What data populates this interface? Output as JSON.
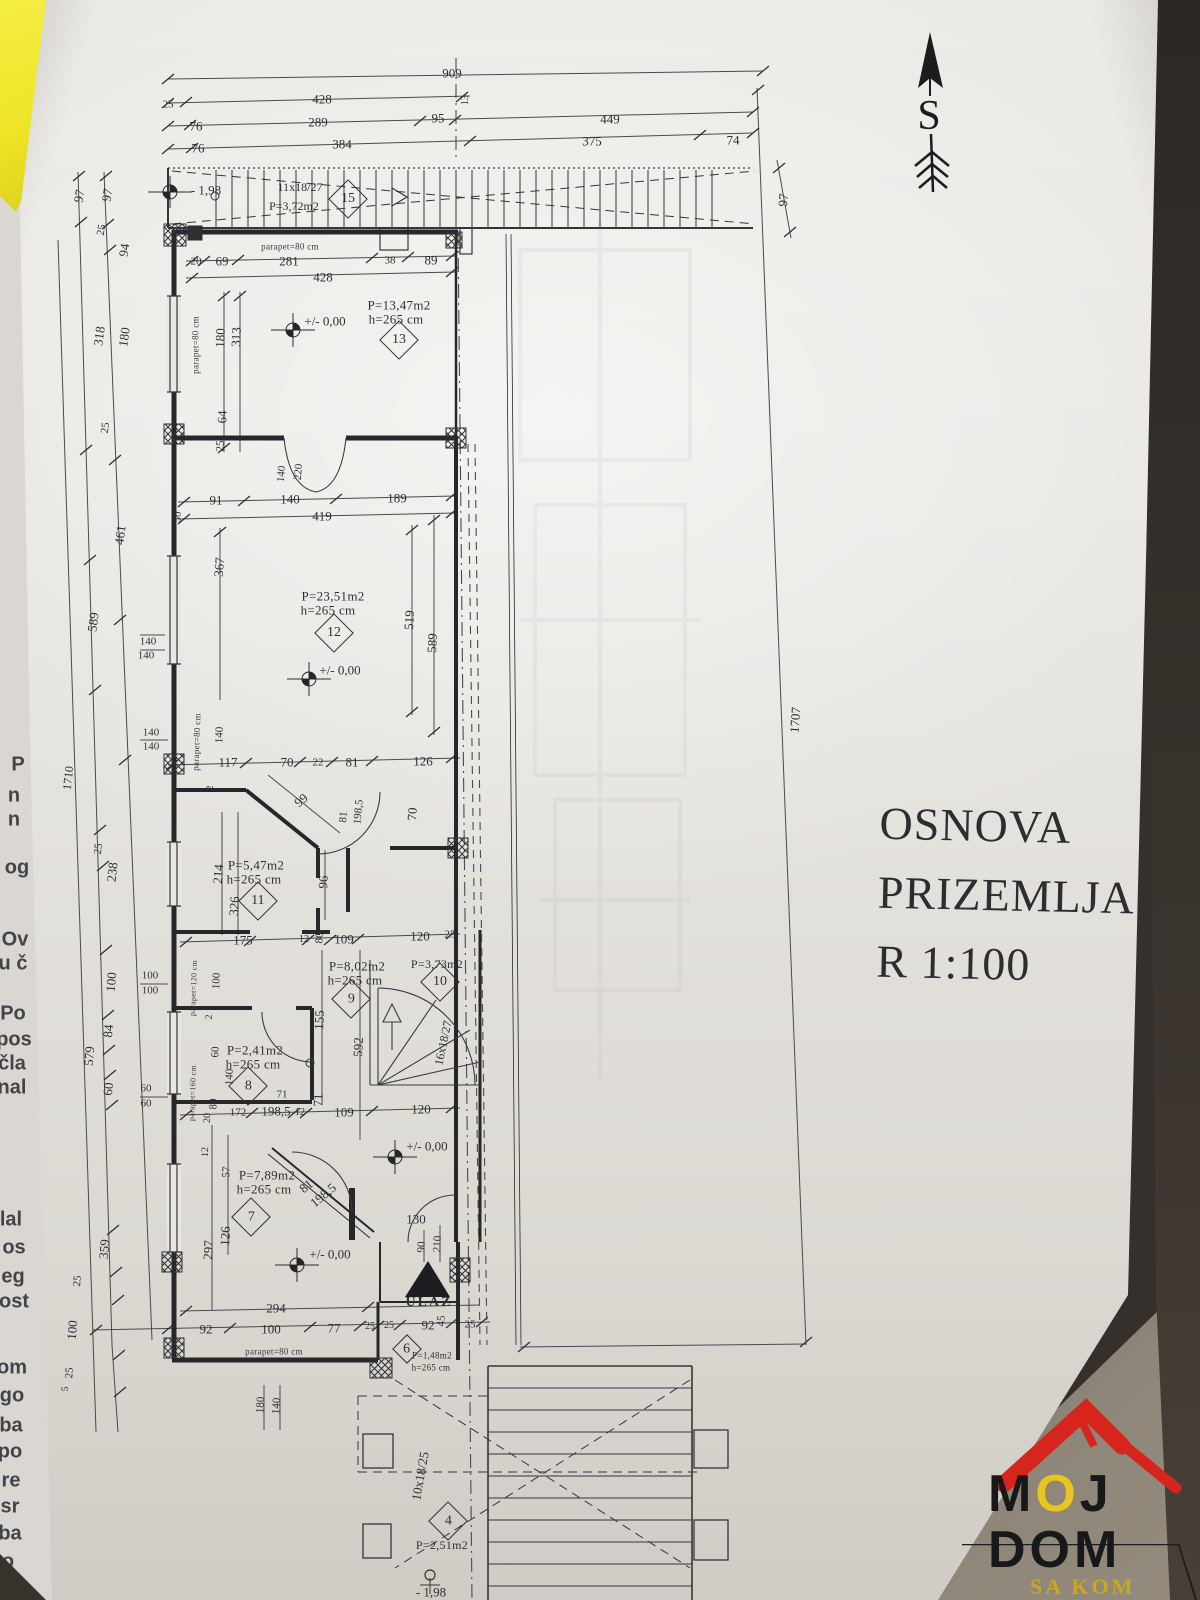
{
  "title_block": {
    "lines": [
      "OSNOVA",
      "PRIZEMLJA",
      "R 1:100"
    ]
  },
  "north": {
    "label": "S"
  },
  "logo": {
    "l1a": "M",
    "l1b": "O",
    "l1c": "J",
    "word2": "DOM",
    "sub": "SA KOM"
  },
  "colors": {
    "paper": "#e8e6e2",
    "line": "#3a3a3e",
    "dark_edge": "#332e29",
    "corner": "#8b8478",
    "yellow_paper": "#f0e832",
    "logo_red": "#d6251d",
    "logo_yellow": "#e8c51f"
  },
  "plan": {
    "labels": [
      {
        "t": "909",
        "x": 452,
        "y": 73
      },
      {
        "t": "25",
        "x": 168,
        "y": 105,
        "s": 11
      },
      {
        "t": "428",
        "x": 322,
        "y": 99
      },
      {
        "t": "13",
        "x": 466,
        "y": 100,
        "r": -90,
        "s": 10
      },
      {
        "t": "76",
        "x": 196,
        "y": 126
      },
      {
        "t": "289",
        "x": 318,
        "y": 122
      },
      {
        "t": "95",
        "x": 438,
        "y": 118
      },
      {
        "t": "449",
        "x": 610,
        "y": 119
      },
      {
        "t": "76",
        "x": 198,
        "y": 148
      },
      {
        "t": "384",
        "x": 342,
        "y": 144
      },
      {
        "t": "375",
        "x": 592,
        "y": 141
      },
      {
        "t": "74",
        "x": 733,
        "y": 140
      },
      {
        "t": "97",
        "x": 783,
        "y": 200,
        "r": -85
      },
      {
        "t": "- 1,98",
        "x": 206,
        "y": 190,
        "c": "lvl"
      },
      {
        "t": "11x18/27",
        "x": 300,
        "y": 187,
        "s": 12
      },
      {
        "t": "P=3,72m2",
        "x": 294,
        "y": 206,
        "s": 12
      },
      {
        "t": "97",
        "x": 79,
        "y": 196,
        "r": -80
      },
      {
        "t": "97",
        "x": 107,
        "y": 195,
        "r": -80
      },
      {
        "t": "25",
        "x": 102,
        "y": 230,
        "r": -80,
        "s": 11
      },
      {
        "t": "94",
        "x": 124,
        "y": 250,
        "r": -82
      },
      {
        "t": "318",
        "x": 99,
        "y": 336,
        "r": -82
      },
      {
        "t": "180",
        "x": 124,
        "y": 337,
        "r": -82
      },
      {
        "t": "25",
        "x": 106,
        "y": 428,
        "r": -83,
        "s": 11
      },
      {
        "t": "461",
        "x": 120,
        "y": 535,
        "r": -83
      },
      {
        "t": "589",
        "x": 93,
        "y": 622,
        "r": -83
      },
      {
        "t": "1710",
        "x": 68,
        "y": 778,
        "r": -84,
        "s": 12
      },
      {
        "t": "25",
        "x": 99,
        "y": 849,
        "r": -84,
        "s": 11
      },
      {
        "t": "238",
        "x": 112,
        "y": 872,
        "r": -84
      },
      {
        "t": "100",
        "x": 111,
        "y": 982,
        "r": -85
      },
      {
        "t": "84",
        "x": 108,
        "y": 1031,
        "r": -85
      },
      {
        "t": "579",
        "x": 89,
        "y": 1056,
        "r": -85
      },
      {
        "t": "60",
        "x": 108,
        "y": 1089,
        "r": -85
      },
      {
        "t": "359",
        "x": 104,
        "y": 1249,
        "r": -85
      },
      {
        "t": "25",
        "x": 78,
        "y": 1281,
        "r": -85,
        "s": 11
      },
      {
        "t": "100",
        "x": 72,
        "y": 1330,
        "r": -86
      },
      {
        "t": "25",
        "x": 70,
        "y": 1373,
        "r": -86,
        "s": 11
      },
      {
        "t": "5",
        "x": 66,
        "y": 1389,
        "r": -86,
        "s": 10
      },
      {
        "t": "140",
        "x": 148,
        "y": 642,
        "s": 11
      },
      {
        "t": "140",
        "x": 146,
        "y": 656,
        "s": 11
      },
      {
        "t": "140",
        "x": 151,
        "y": 733,
        "s": 11
      },
      {
        "t": "140",
        "x": 151,
        "y": 747,
        "s": 11
      },
      {
        "t": "100",
        "x": 150,
        "y": 976,
        "s": 11
      },
      {
        "t": "100",
        "x": 150,
        "y": 991,
        "s": 11
      },
      {
        "t": "60",
        "x": 146,
        "y": 1089,
        "s": 11
      },
      {
        "t": "60",
        "x": 146,
        "y": 1104,
        "s": 11
      },
      {
        "t": "parapet=80 cm",
        "x": 290,
        "y": 247,
        "c": "par",
        "s": 9
      },
      {
        "t": "20",
        "x": 196,
        "y": 262,
        "s": 11
      },
      {
        "t": "69",
        "x": 222,
        "y": 261
      },
      {
        "t": "281",
        "x": 289,
        "y": 261
      },
      {
        "t": "38",
        "x": 390,
        "y": 261,
        "s": 11
      },
      {
        "t": "89",
        "x": 431,
        "y": 260
      },
      {
        "t": "428",
        "x": 323,
        "y": 277
      },
      {
        "t": "P=13,47m2",
        "x": 399,
        "y": 305,
        "c": "room"
      },
      {
        "t": "h=265 cm",
        "x": 396,
        "y": 319,
        "c": "room"
      },
      {
        "t": "+/- 0,00",
        "x": 325,
        "y": 321,
        "c": "lvl"
      },
      {
        "t": "parapet=80 cm",
        "x": 196,
        "y": 345,
        "r": -90,
        "c": "par",
        "s": 9
      },
      {
        "t": "180",
        "x": 220,
        "y": 338,
        "r": -88
      },
      {
        "t": "313",
        "x": 236,
        "y": 337,
        "r": -88
      },
      {
        "t": "64",
        "x": 222,
        "y": 417,
        "r": -88
      },
      {
        "t": "25",
        "x": 221,
        "y": 446,
        "r": -88,
        "s": 11
      },
      {
        "t": "140",
        "x": 282,
        "y": 474,
        "r": -85,
        "s": 11
      },
      {
        "t": "220",
        "x": 299,
        "y": 472,
        "r": -85,
        "s": 11
      },
      {
        "t": "91",
        "x": 216,
        "y": 500
      },
      {
        "t": "140",
        "x": 290,
        "y": 499
      },
      {
        "t": "189",
        "x": 397,
        "y": 498
      },
      {
        "t": "419",
        "x": 322,
        "y": 516
      },
      {
        "t": "30",
        "x": 178,
        "y": 517,
        "r": -85,
        "s": 11
      },
      {
        "t": "367",
        "x": 219,
        "y": 567,
        "r": -86
      },
      {
        "t": "P=23,51m2",
        "x": 333,
        "y": 596,
        "c": "room"
      },
      {
        "t": "h=265 cm",
        "x": 328,
        "y": 610,
        "c": "room"
      },
      {
        "t": "+/- 0,00",
        "x": 340,
        "y": 670,
        "c": "lvl"
      },
      {
        "t": "519",
        "x": 409,
        "y": 620,
        "r": -87
      },
      {
        "t": "589",
        "x": 432,
        "y": 643,
        "r": -87
      },
      {
        "t": "parapet=80 cm",
        "x": 197,
        "y": 742,
        "r": -88,
        "c": "par",
        "s": 9
      },
      {
        "t": "140",
        "x": 220,
        "y": 735,
        "r": -88,
        "s": 11
      },
      {
        "t": "117",
        "x": 228,
        "y": 762
      },
      {
        "t": "70",
        "x": 287,
        "y": 762
      },
      {
        "t": "22",
        "x": 318,
        "y": 763,
        "s": 11
      },
      {
        "t": "81",
        "x": 352,
        "y": 762
      },
      {
        "t": "126",
        "x": 423,
        "y": 761
      },
      {
        "t": "2",
        "x": 211,
        "y": 788,
        "r": -88,
        "s": 10
      },
      {
        "t": "99",
        "x": 301,
        "y": 800,
        "r": -40
      },
      {
        "t": "81",
        "x": 344,
        "y": 817,
        "r": -85,
        "s": 11
      },
      {
        "t": "198,5",
        "x": 359,
        "y": 812,
        "r": -85,
        "s": 11
      },
      {
        "t": "70",
        "x": 412,
        "y": 814,
        "r": -87
      },
      {
        "t": "P=5,47m2",
        "x": 256,
        "y": 865,
        "c": "room"
      },
      {
        "t": "h=265 cm",
        "x": 254,
        "y": 879,
        "c": "room"
      },
      {
        "t": "214",
        "x": 218,
        "y": 874,
        "r": -86
      },
      {
        "t": "326",
        "x": 234,
        "y": 906,
        "r": -86
      },
      {
        "t": "96",
        "x": 323,
        "y": 882,
        "r": -87
      },
      {
        "t": "175",
        "x": 243,
        "y": 940
      },
      {
        "t": "12",
        "x": 304,
        "y": 940,
        "s": 10
      },
      {
        "t": "80",
        "x": 320,
        "y": 938,
        "r": -87,
        "s": 11
      },
      {
        "t": "109",
        "x": 344,
        "y": 939
      },
      {
        "t": "120",
        "x": 420,
        "y": 936
      },
      {
        "t": "25",
        "x": 450,
        "y": 935,
        "s": 11
      },
      {
        "t": "P=8,02m2",
        "x": 357,
        "y": 966,
        "c": "room"
      },
      {
        "t": "h=265 cm",
        "x": 355,
        "y": 980,
        "c": "room"
      },
      {
        "t": "P=3,73m2",
        "x": 437,
        "y": 964,
        "s": 12,
        "c": "room"
      },
      {
        "t": "155",
        "x": 319,
        "y": 1020,
        "r": -87
      },
      {
        "t": "592",
        "x": 358,
        "y": 1047,
        "r": -87
      },
      {
        "t": "16x18/27",
        "x": 443,
        "y": 1043,
        "r": -78,
        "s": 12
      },
      {
        "t": "71",
        "x": 318,
        "y": 1100,
        "r": -87
      },
      {
        "t": "109",
        "x": 344,
        "y": 1112
      },
      {
        "t": "120",
        "x": 421,
        "y": 1109
      },
      {
        "t": "100",
        "x": 217,
        "y": 981,
        "r": -87,
        "s": 11
      },
      {
        "t": "parapet=120 cm",
        "x": 194,
        "y": 988,
        "r": -88,
        "c": "par",
        "s": 8
      },
      {
        "t": "2",
        "x": 210,
        "y": 1017,
        "r": -88,
        "s": 10
      },
      {
        "t": "60",
        "x": 216,
        "y": 1052,
        "r": -88,
        "s": 11
      },
      {
        "t": "P=2,41m2",
        "x": 255,
        "y": 1050,
        "c": "room"
      },
      {
        "t": "h=265 cm",
        "x": 253,
        "y": 1064,
        "c": "room"
      },
      {
        "t": "140",
        "x": 230,
        "y": 1077,
        "r": -88,
        "s": 11
      },
      {
        "t": "parapet=160 cm",
        "x": 193,
        "y": 1093,
        "r": -88,
        "c": "par",
        "s": 8
      },
      {
        "t": "80",
        "x": 214,
        "y": 1104,
        "r": -88,
        "s": 11
      },
      {
        "t": "20",
        "x": 208,
        "y": 1118,
        "r": -88,
        "s": 10
      },
      {
        "t": "71",
        "x": 282,
        "y": 1095,
        "s": 11
      },
      {
        "t": "172",
        "x": 238,
        "y": 1113,
        "s": 11
      },
      {
        "t": "198,5",
        "x": 276,
        "y": 1111
      },
      {
        "t": "12",
        "x": 300,
        "y": 1113,
        "s": 10
      },
      {
        "t": "12",
        "x": 206,
        "y": 1152,
        "r": -88,
        "s": 10
      },
      {
        "t": "57",
        "x": 227,
        "y": 1172,
        "r": -88,
        "s": 11
      },
      {
        "t": "P=7,89m2",
        "x": 267,
        "y": 1175,
        "c": "room"
      },
      {
        "t": "h=265 cm",
        "x": 264,
        "y": 1189,
        "c": "room"
      },
      {
        "t": "81",
        "x": 306,
        "y": 1186,
        "r": -40
      },
      {
        "t": "198,5",
        "x": 323,
        "y": 1195,
        "r": -40
      },
      {
        "t": "126",
        "x": 225,
        "y": 1236,
        "r": -87
      },
      {
        "t": "297",
        "x": 208,
        "y": 1250,
        "r": -87
      },
      {
        "t": "+/- 0,00",
        "x": 330,
        "y": 1254,
        "c": "lvl"
      },
      {
        "t": "+/- 0,00",
        "x": 427,
        "y": 1146,
        "c": "lvl"
      },
      {
        "t": "130",
        "x": 416,
        "y": 1219
      },
      {
        "t": "90",
        "x": 422,
        "y": 1247,
        "r": -88,
        "s": 11
      },
      {
        "t": "210",
        "x": 438,
        "y": 1244,
        "r": -88,
        "s": 11
      },
      {
        "t": "ULAZ",
        "x": 429,
        "y": 1303,
        "s": 14,
        "c": "ulaz"
      },
      {
        "t": "294",
        "x": 276,
        "y": 1308
      },
      {
        "t": "92",
        "x": 206,
        "y": 1329
      },
      {
        "t": "100",
        "x": 271,
        "y": 1329
      },
      {
        "t": "77",
        "x": 334,
        "y": 1328
      },
      {
        "t": "25",
        "x": 370,
        "y": 1327,
        "s": 10
      },
      {
        "t": "25",
        "x": 389,
        "y": 1326,
        "s": 10
      },
      {
        "t": "92",
        "x": 428,
        "y": 1325
      },
      {
        "t": "45",
        "x": 442,
        "y": 1321,
        "r": -88,
        "s": 11
      },
      {
        "t": "25",
        "x": 470,
        "y": 1325,
        "s": 11
      },
      {
        "t": "parapet=80 cm",
        "x": 274,
        "y": 1352,
        "c": "par",
        "s": 9
      },
      {
        "t": "180",
        "x": 261,
        "y": 1405,
        "r": -87,
        "s": 11
      },
      {
        "t": "140",
        "x": 277,
        "y": 1406,
        "r": -87,
        "s": 11
      },
      {
        "t": "P=1,48m2",
        "x": 432,
        "y": 1356,
        "s": 9,
        "c": "room"
      },
      {
        "t": "h=265 cm",
        "x": 431,
        "y": 1368,
        "s": 9,
        "c": "room"
      },
      {
        "t": "10x18/25",
        "x": 420,
        "y": 1476,
        "r": -80,
        "s": 13
      },
      {
        "t": "P=2,51m2",
        "x": 442,
        "y": 1545,
        "s": 12,
        "c": "room"
      },
      {
        "t": "- 1,98",
        "x": 431,
        "y": 1592,
        "c": "lvl"
      },
      {
        "t": "1707",
        "x": 795,
        "y": 720,
        "r": -86
      }
    ],
    "room_ids": [
      {
        "n": "15",
        "x": 348,
        "y": 199
      },
      {
        "n": "13",
        "x": 399,
        "y": 340
      },
      {
        "n": "12",
        "x": 334,
        "y": 633
      },
      {
        "n": "11",
        "x": 258,
        "y": 901
      },
      {
        "n": "10",
        "x": 440,
        "y": 982
      },
      {
        "n": "9",
        "x": 351,
        "y": 999
      },
      {
        "n": "8",
        "x": 248,
        "y": 1086
      },
      {
        "n": "7",
        "x": 251,
        "y": 1217
      },
      {
        "n": "6",
        "x": 407,
        "y": 1349,
        "sz": 19
      },
      {
        "n": "4",
        "x": 448,
        "y": 1521
      }
    ],
    "level_markers": [
      {
        "x": 170,
        "y": 192
      },
      {
        "x": 293,
        "y": 330
      },
      {
        "x": 309,
        "y": 679
      },
      {
        "x": 297,
        "y": 1265
      },
      {
        "x": 395,
        "y": 1157
      }
    ]
  },
  "page_fragments": [
    {
      "t": "P",
      "x": 18,
      "y": 765,
      "s": 20
    },
    {
      "t": "n",
      "x": 14,
      "y": 796,
      "s": 20
    },
    {
      "t": "n",
      "x": 14,
      "y": 820,
      "s": 20
    },
    {
      "t": "og",
      "x": 17,
      "y": 868,
      "s": 20
    },
    {
      "t": "Ov",
      "x": 15,
      "y": 940,
      "s": 20
    },
    {
      "t": "u č",
      "x": 13,
      "y": 964,
      "s": 20
    },
    {
      "t": "Po",
      "x": 13,
      "y": 1014,
      "s": 20
    },
    {
      "t": "pos",
      "x": 14,
      "y": 1040,
      "s": 20
    },
    {
      "t": "čla",
      "x": 12,
      "y": 1064,
      "s": 20
    },
    {
      "t": "nal",
      "x": 12,
      "y": 1088,
      "s": 20
    },
    {
      "t": "lal",
      "x": 11,
      "y": 1220,
      "s": 20
    },
    {
      "t": "os",
      "x": 14,
      "y": 1248,
      "s": 20
    },
    {
      "t": "eg",
      "x": 13,
      "y": 1277,
      "s": 20
    },
    {
      "t": "ost",
      "x": 14,
      "y": 1302,
      "s": 20
    },
    {
      "t": "om",
      "x": 12,
      "y": 1368,
      "s": 20
    },
    {
      "t": "go",
      "x": 12,
      "y": 1396,
      "s": 20
    },
    {
      "t": "ba",
      "x": 11,
      "y": 1426,
      "s": 20
    },
    {
      "t": "po",
      "x": 10,
      "y": 1452,
      "s": 20
    },
    {
      "t": "re",
      "x": 11,
      "y": 1481,
      "s": 20
    },
    {
      "t": "sr",
      "x": 10,
      "y": 1507,
      "s": 20
    },
    {
      "t": "ba",
      "x": 10,
      "y": 1534,
      "s": 20
    },
    {
      "t": "o",
      "x": 8,
      "y": 1562,
      "s": 20
    }
  ]
}
